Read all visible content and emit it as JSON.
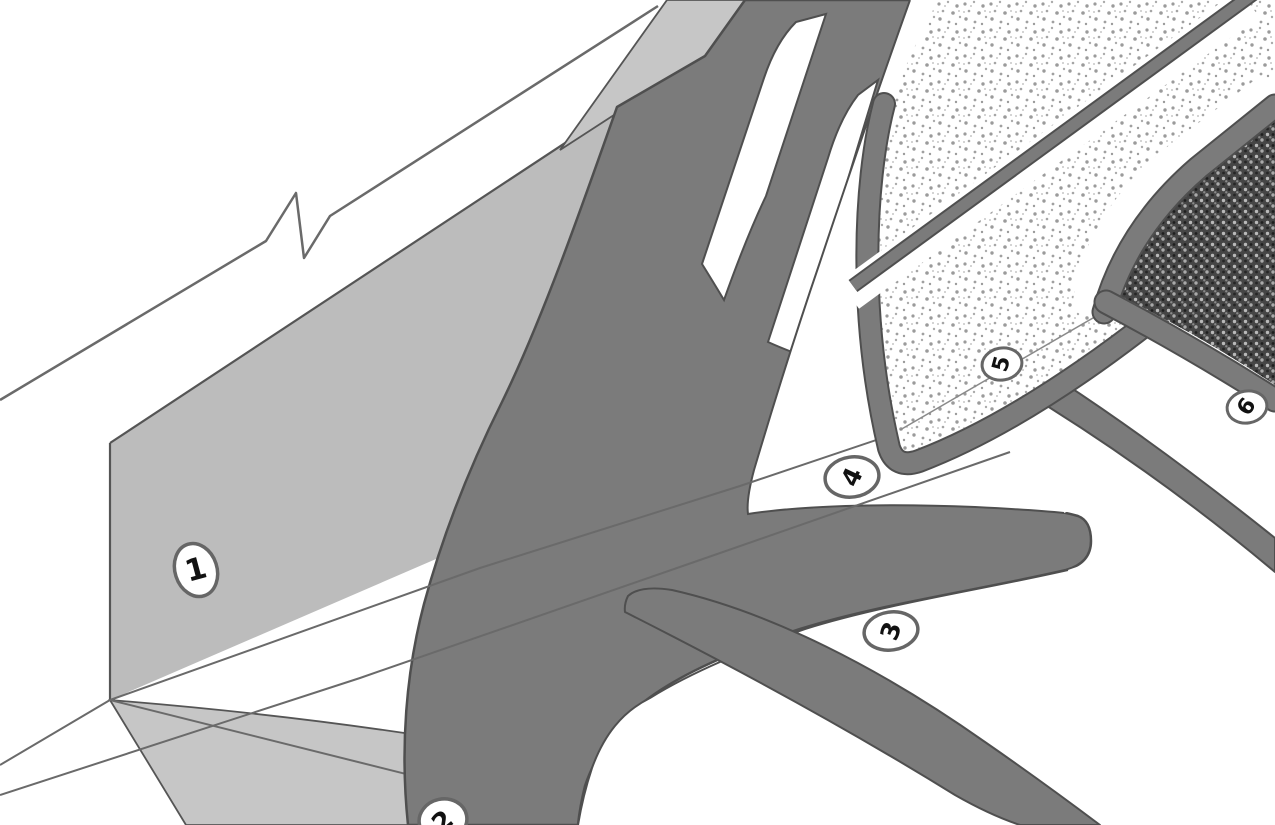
{
  "figure": {
    "title": "",
    "type": "isometric-construction-detail",
    "callouts": [
      {
        "value": "1"
      },
      {
        "value": "2"
      },
      {
        "value": "3"
      },
      {
        "value": "4"
      },
      {
        "value": "5"
      },
      {
        "value": "6"
      }
    ],
    "colors": {
      "background": "#ffffff",
      "wall_gray": "#bcbcbc",
      "flashing_light_gray": "#c6c6c6",
      "membrane_band_gray": "#7b7b7b",
      "outline": "#4f4f4f",
      "thin_line": "#6a6a6a",
      "stipple_dot": "#9b9b9b",
      "hatch_dark": "#454545",
      "hatch_light": "#b9b9b9",
      "callout_ring": "#666666",
      "callout_text": "#111111",
      "ply_white": "#ffffff"
    },
    "textures": {
      "insulation_board": "stipple",
      "cap_layer": "crosshatch"
    }
  }
}
